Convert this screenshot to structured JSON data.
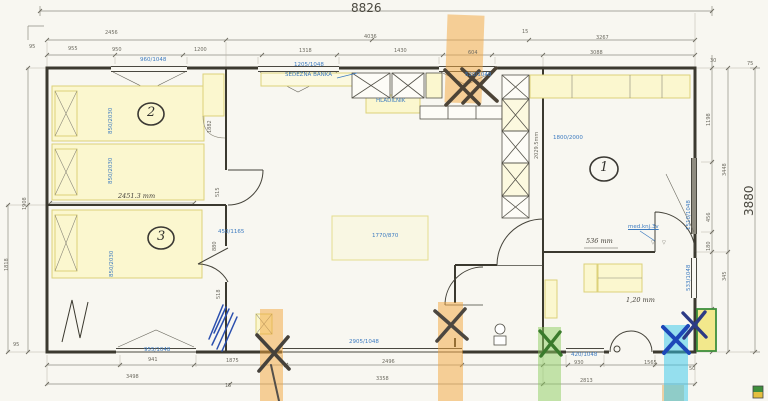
{
  "drawing": {
    "overall": {
      "width_mm": "8826",
      "height_mm": "3880"
    },
    "room_numbers": {
      "living": "1",
      "bedroom_small": "2",
      "bedroom_kids": "3"
    },
    "blue": {
      "win_top_left": "960/1048",
      "win_top_mid": "1205/1048",
      "bench": "SEDEŽNA BANKA",
      "fridge": "HLADILNIK",
      "win_top_kitchen": "520/1048",
      "bed_master": "1800/2000",
      "win_right": "1510/1048",
      "bed2_a": "850/2030",
      "bed2_b": "850/2030",
      "bed3": "850/2030",
      "win_bottom_left": "955/1048",
      "win_bottom_mid": "2905/1048",
      "win_bath": "420/1048",
      "win_hall": "533/1048",
      "table": "1770/870",
      "cabinet": "450/1165",
      "note": "med.knj.3v"
    },
    "handwritten": {
      "room_width": "2451.3 mm",
      "seat": "536 mm",
      "entry": "1,20 mm"
    },
    "dims": {
      "t2_1": "2456",
      "t2_2": "4036",
      "t2_3": "15",
      "t2_4": "3267",
      "t3_1": "95",
      "t3_2": "955",
      "t3_3": "950",
      "t3_4": "1200",
      "t3_5": "1318",
      "t3_6": "1430",
      "t3_7": "604",
      "t3_8": "3088",
      "b1_1": "941",
      "b1_2": "1875",
      "b1_3": "2496",
      "b1_4": "930",
      "b1_5": "1565",
      "b1_6": "50",
      "b2_1": "3498",
      "b2_2": "15",
      "b2_3": "3358",
      "b2_4": "2813",
      "r_1": "30",
      "r_2": "75",
      "r_3": "1198",
      "r_4": "3448",
      "r_5": "456",
      "r_6": "180",
      "r_7": "345",
      "l_1": "1908",
      "l_2": "1818",
      "l_3": "95",
      "i_1": "1882",
      "i_2": "515",
      "i_3": "880",
      "i_4": "518",
      "i_5": "2029.5mm",
      "lv_1": "▽",
      "lv_2": "▽"
    },
    "colors": {
      "cad_blue": "#3d7bc0",
      "highlight_orange": "#f0a64a",
      "highlight_green": "#8cc95e",
      "highlight_cyan": "#3cc8e6",
      "furniture_yellow": "#fbf7cf",
      "ink": "#3b392f"
    }
  }
}
